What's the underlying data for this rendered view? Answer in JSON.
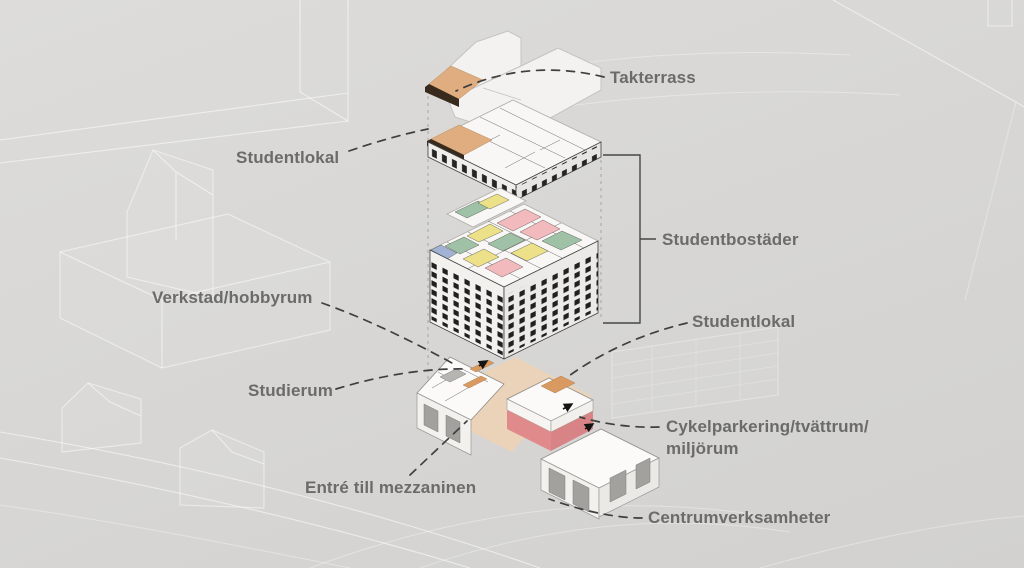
{
  "diagram": {
    "type": "exploded-axonometric-architecture-diagram",
    "language": "sv",
    "labels": {
      "takterrass": "Takterrass",
      "studentlokal_top": "Studentlokal",
      "studentbostader": "Studentbostäder",
      "verkstad_hobbyrum": "Verkstad/hobbyrum",
      "studierum": "Studierum",
      "studentlokal_bottom": "Studentlokal",
      "entre_mezzanin": "Entré till mezzaninen",
      "cykelparkering_line1": "Cykelparkering/tvättrum/",
      "cykelparkering_line2": "miljörum",
      "centrumverksamheter": "Centrumverksamheter"
    },
    "colors": {
      "background": "#d8d7d5",
      "label_text": "#6b6b6b",
      "leader_line": "#3f3f3f",
      "context_lines": "#ffffff",
      "building_white": "#f3f2f0",
      "window_dark": "#20201e",
      "terrace_orange": "#dfad80",
      "terrace_dark_edge": "#382b1e",
      "stair_orange": "#d89a61",
      "room_green": "#9fc2a7",
      "room_yellow": "#ece188",
      "room_pink": "#f2babc",
      "room_blue": "#a2b2d4",
      "red_band": "#e08a8c",
      "floor_peach": "#ebd3b9",
      "storefront_gray": "#a3a19d"
    }
  }
}
